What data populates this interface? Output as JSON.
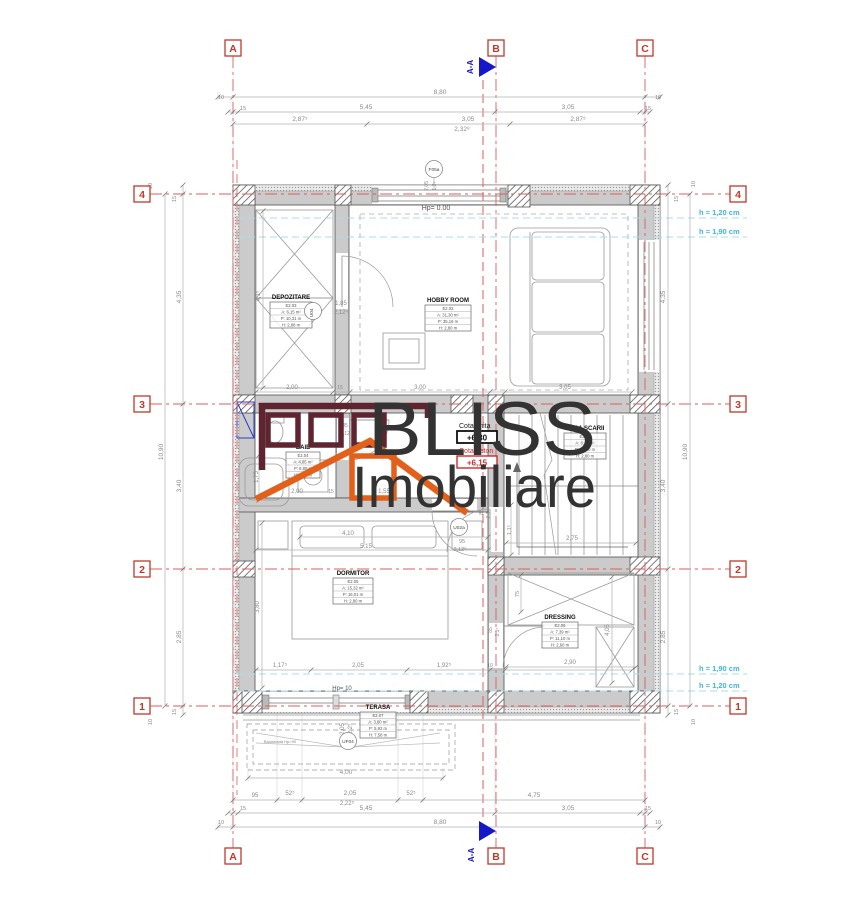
{
  "watermark": {
    "line1": "BLISS",
    "line2": "Imobiliare"
  },
  "section": {
    "label": "A-A"
  },
  "cota": {
    "finita_label": "Cota finita",
    "finita_value": "+6,30",
    "beton_label": "Cota beton",
    "beton_value": "+6,15"
  },
  "axis_letters": [
    {
      "id": "A",
      "x": 233
    },
    {
      "id": "B",
      "x": 496
    },
    {
      "id": "C",
      "x": 645
    }
  ],
  "axis_numbers": [
    {
      "id": "4",
      "y": 194
    },
    {
      "id": "3",
      "y": 404
    },
    {
      "id": "2",
      "y": 569
    },
    {
      "id": "1",
      "y": 706
    }
  ],
  "height_labels": [
    {
      "t": "h = 1,20 cm",
      "x": 699,
      "y": 215
    },
    {
      "t": "h = 1,90 cm",
      "x": 699,
      "y": 234
    },
    {
      "t": "h = 1,90 cm",
      "x": 699,
      "y": 671
    },
    {
      "t": "h = 1,20 cm",
      "x": 699,
      "y": 688
    }
  ],
  "rooms": [
    {
      "name": "DEPOZITARE",
      "code": "E2.03",
      "area": "A: 6,15 m²",
      "perim": "P: 10,31 m",
      "h": "H: 2,88 m",
      "tx": 270,
      "ty": 302,
      "tw": 42
    },
    {
      "name": "HOBBY ROOM",
      "code": "E2.02",
      "area": "A: 31,30 m²",
      "perim": "P: 35,16 m",
      "h": "H: 2,80 m",
      "tx": 425,
      "ty": 305,
      "tw": 46
    },
    {
      "name": "CASA SCARII",
      "code": "E2.01",
      "area": "A: 8,43 m²",
      "perim": "P: 12,80 m",
      "h": "H: 2,80 m",
      "tx": 564,
      "ty": 433,
      "tw": 42
    },
    {
      "name": "BAIE",
      "code": "E2.04",
      "area": "A: 4,85 m²",
      "perim": "P: 8,85 m",
      "h": "H: 2,80 m",
      "tx": 286,
      "ty": 452,
      "tw": 34
    },
    {
      "name": "DORMITOR",
      "code": "E2.05",
      "area": "A: 15,32 m²",
      "perim": "P: 16,01 m",
      "h": "H: 2,80 m",
      "tx": 333,
      "ty": 578,
      "tw": 40
    },
    {
      "name": "DRESSING",
      "code": "E2.06",
      "area": "A: 7,39 m²",
      "perim": "P: 11,10 m",
      "h": "H: 2,60 m",
      "tx": 542,
      "ty": 622,
      "tw": 36
    },
    {
      "name": "TERASA",
      "code": "E2.07",
      "area": "A: 3,80 m²",
      "perim": "P: 5,92 m",
      "h": "H: 7,58 m",
      "tx": 360,
      "ty": 712,
      "tw": 36
    }
  ],
  "door_labels": [
    {
      "t": "F05a",
      "x": 434,
      "y": 169
    },
    {
      "t": "U04",
      "x": 313,
      "y": 311,
      "rot": -90
    },
    {
      "t": "U02a",
      "x": 459,
      "y": 527
    },
    {
      "t": "UF04",
      "x": 348,
      "y": 741
    }
  ],
  "notes": [
    {
      "t": "Hp= 0.00",
      "x": 436,
      "y": 210,
      "s": 7,
      "c": "#555"
    },
    {
      "t": "Hp= 10",
      "x": 342,
      "y": 690,
      "s": 6,
      "c": "#555"
    },
    {
      "t": "Balustrada Hp=90",
      "x": 280,
      "y": 743,
      "s": 4,
      "c": "#888"
    }
  ],
  "dims": [
    {
      "t": "8,80",
      "x": 440,
      "y": 94
    },
    {
      "t": "10",
      "x": 221,
      "y": 99,
      "s": 5.5
    },
    {
      "t": "10",
      "x": 658,
      "y": 99,
      "s": 5.5
    },
    {
      "t": "15",
      "x": 243,
      "y": 110,
      "s": 5.5
    },
    {
      "t": "5,45",
      "x": 366,
      "y": 109
    },
    {
      "t": "3,05",
      "x": 568,
      "y": 109
    },
    {
      "t": "15",
      "x": 648,
      "y": 110,
      "s": 5.5
    },
    {
      "t": "2,87⁵",
      "x": 300,
      "y": 121
    },
    {
      "t": "3,05",
      "x": 468,
      "y": 121
    },
    {
      "t": "2,87⁵",
      "x": 578,
      "y": 121
    },
    {
      "t": "2,32⁸",
      "x": 462,
      "y": 131
    },
    {
      "t": "95",
      "x": 255,
      "y": 797,
      "s": 6
    },
    {
      "t": "52⁵",
      "x": 290,
      "y": 795,
      "s": 6
    },
    {
      "t": "2,05",
      "x": 350,
      "y": 795
    },
    {
      "t": "2,22⁵",
      "x": 347,
      "y": 805,
      "s": 6
    },
    {
      "t": "52⁵",
      "x": 411,
      "y": 795,
      "s": 6
    },
    {
      "t": "4,75",
      "x": 534,
      "y": 797
    },
    {
      "t": "15",
      "x": 243,
      "y": 810,
      "s": 5.5
    },
    {
      "t": "5,45",
      "x": 366,
      "y": 810
    },
    {
      "t": "3,05",
      "x": 568,
      "y": 810
    },
    {
      "t": "15",
      "x": 648,
      "y": 810,
      "s": 5.5
    },
    {
      "t": "10",
      "x": 221,
      "y": 824,
      "s": 5.5
    },
    {
      "t": "8,80",
      "x": 440,
      "y": 824
    },
    {
      "t": "10",
      "x": 658,
      "y": 824,
      "s": 5.5
    },
    {
      "t": "4,00",
      "x": 346,
      "y": 774
    },
    {
      "t": "10",
      "x": 152,
      "y": 186,
      "rot": -90,
      "s": 5.5
    },
    {
      "t": "15",
      "x": 176,
      "y": 199,
      "rot": -90,
      "s": 5.5
    },
    {
      "t": "4,35",
      "x": 181,
      "y": 297,
      "rot": -90
    },
    {
      "t": "10,90",
      "x": 163,
      "y": 452,
      "rot": -90
    },
    {
      "t": "3,40",
      "x": 181,
      "y": 486,
      "rot": -90
    },
    {
      "t": "2,85",
      "x": 181,
      "y": 637,
      "rot": -90
    },
    {
      "t": "15",
      "x": 176,
      "y": 712,
      "rot": -90,
      "s": 5.5
    },
    {
      "t": "10",
      "x": 152,
      "y": 722,
      "rot": -90,
      "s": 5.5
    },
    {
      "t": "10",
      "x": 695,
      "y": 184,
      "rot": -90,
      "s": 5.5
    },
    {
      "t": "15",
      "x": 678,
      "y": 199,
      "rot": -90,
      "s": 5.5
    },
    {
      "t": "4,35",
      "x": 665,
      "y": 297,
      "rot": -90
    },
    {
      "t": "3,40",
      "x": 665,
      "y": 486,
      "rot": -90
    },
    {
      "t": "2,85",
      "x": 665,
      "y": 637,
      "rot": -90
    },
    {
      "t": "10,90",
      "x": 687,
      "y": 452,
      "rot": -90
    },
    {
      "t": "15",
      "x": 678,
      "y": 712,
      "rot": -90,
      "s": 5.5
    },
    {
      "t": "10",
      "x": 695,
      "y": 722,
      "rot": -90,
      "s": 5.5
    },
    {
      "t": "2,00",
      "x": 292,
      "y": 389,
      "s": 6
    },
    {
      "t": "15",
      "x": 340,
      "y": 389,
      "s": 5
    },
    {
      "t": "3,00",
      "x": 420,
      "y": 389,
      "s": 6
    },
    {
      "t": "3,05",
      "x": 565,
      "y": 389,
      "s": 6
    },
    {
      "t": "4,1⁵",
      "x": 260,
      "y": 296,
      "rot": -90,
      "s": 6
    },
    {
      "t": "1,85",
      "x": 341,
      "y": 305,
      "s": 6
    },
    {
      "t": "2,12⁴",
      "x": 341,
      "y": 314,
      "s": 6
    },
    {
      "t": "2,05",
      "x": 428,
      "y": 186,
      "rot": -90,
      "s": 5
    },
    {
      "t": "1,2⁵",
      "x": 436,
      "y": 186,
      "rot": -90,
      "s": 5
    },
    {
      "t": "1,75",
      "x": 258,
      "y": 477,
      "rot": -90,
      "s": 6
    },
    {
      "t": "2,00",
      "x": 297,
      "y": 493,
      "s": 6
    },
    {
      "t": "15",
      "x": 331,
      "y": 493,
      "s": 5
    },
    {
      "t": "1,55",
      "x": 384,
      "y": 493,
      "s": 6
    },
    {
      "t": "85",
      "x": 345,
      "y": 427,
      "s": 5
    },
    {
      "t": "2,12",
      "x": 345,
      "y": 435,
      "s": 5
    },
    {
      "t": "95",
      "x": 462,
      "y": 543,
      "s": 5.5
    },
    {
      "t": "2,12⁵",
      "x": 460,
      "y": 551,
      "s": 5.5
    },
    {
      "t": "85",
      "x": 483,
      "y": 512,
      "rot": -90,
      "s": 5
    },
    {
      "t": "2,1⁵",
      "x": 490,
      "y": 514,
      "rot": -90,
      "s": 5
    },
    {
      "t": "4,10",
      "x": 348,
      "y": 535,
      "s": 6
    },
    {
      "t": "5,15",
      "x": 366,
      "y": 548,
      "s": 6
    },
    {
      "t": "2,75",
      "x": 572,
      "y": 540,
      "s": 6
    },
    {
      "t": "1,1⁵",
      "x": 511,
      "y": 530,
      "rot": -90,
      "s": 5.5
    },
    {
      "t": "3,80",
      "x": 259,
      "y": 607,
      "rot": -90,
      "s": 6
    },
    {
      "t": "75",
      "x": 519,
      "y": 594,
      "rot": -90,
      "s": 5.5
    },
    {
      "t": "4,05",
      "x": 609,
      "y": 630,
      "rot": -90,
      "s": 6
    },
    {
      "t": "85",
      "x": 492,
      "y": 630,
      "rot": -90,
      "s": 5
    },
    {
      "t": "2,1⁵",
      "x": 499,
      "y": 632,
      "rot": -90,
      "s": 5
    },
    {
      "t": "1,17⁵",
      "x": 280,
      "y": 667,
      "s": 6
    },
    {
      "t": "2,05",
      "x": 358,
      "y": 667,
      "s": 6
    },
    {
      "t": "1,92⁵",
      "x": 444,
      "y": 667,
      "s": 6
    },
    {
      "t": "10",
      "x": 490,
      "y": 667,
      "s": 5
    },
    {
      "t": "2,90",
      "x": 570,
      "y": 664,
      "s": 6
    },
    {
      "t": "2,05",
      "x": 344,
      "y": 729,
      "rot": -90,
      "s": 6
    },
    {
      "t": "2,2⁵",
      "x": 352,
      "y": 729,
      "rot": -90,
      "s": 6
    }
  ],
  "colors": {
    "axis_red": "#c0392b",
    "line_red": "#d95f5f",
    "cyan_text": "#3fb6da",
    "cyan_line": "#a8dcea",
    "section_blue": "#1518c8",
    "wall_gray": "#cbcbcb",
    "logo_maroon": "#5e2531",
    "logo_orange": "#e2601a",
    "logo_text": "#333333",
    "cota_red": "#cc2a2a",
    "dim_gray": "#8a8a8a"
  }
}
